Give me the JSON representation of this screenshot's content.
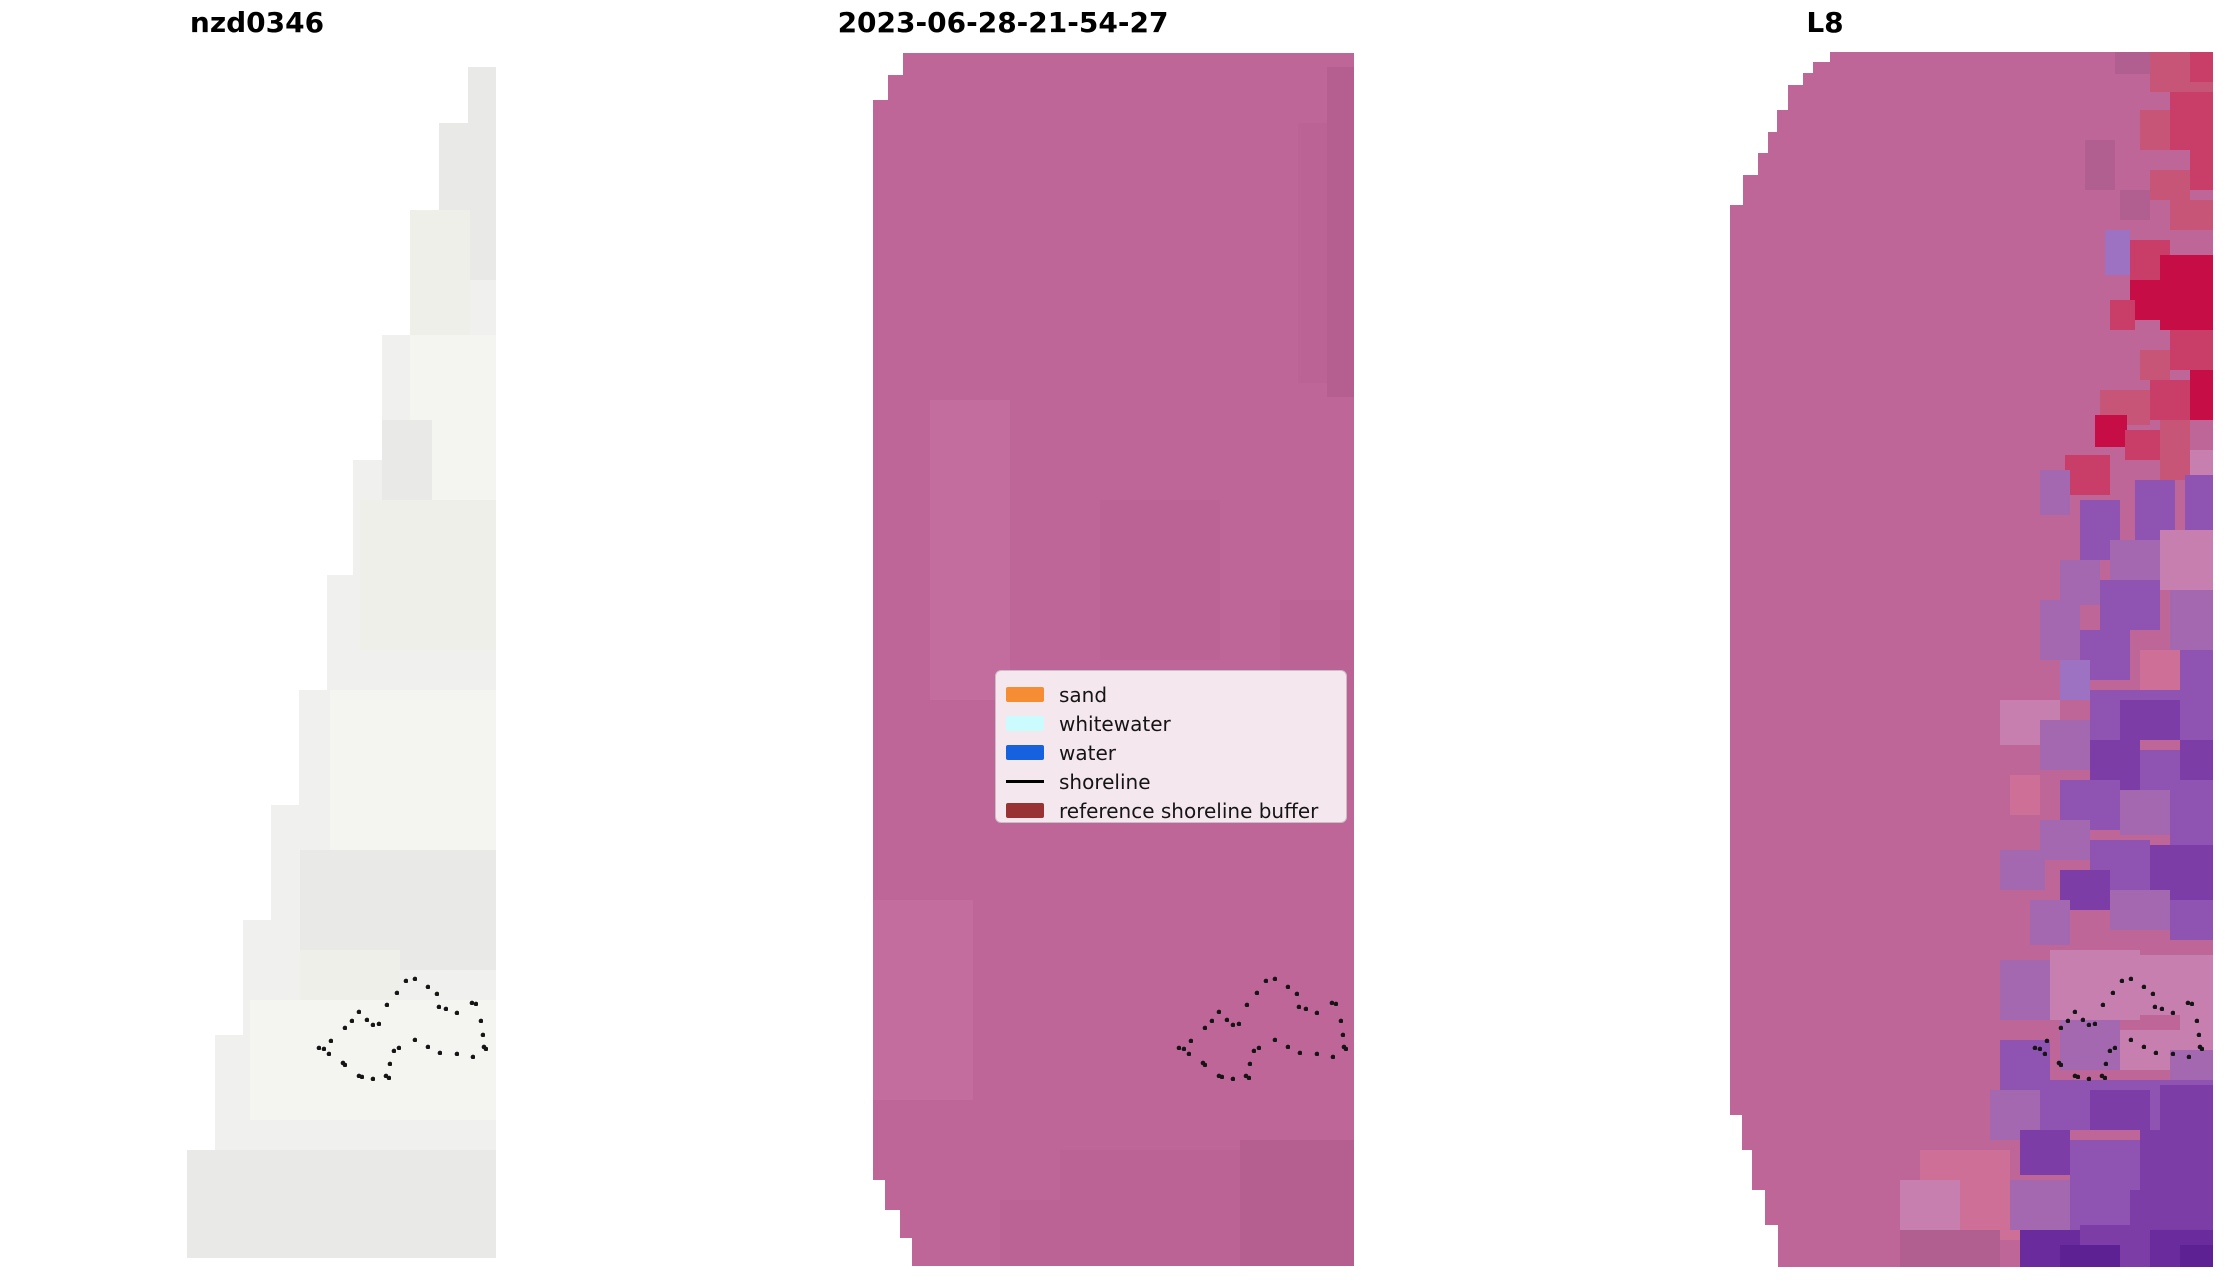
{
  "figure": {
    "width": 2225,
    "height": 1283,
    "background": "#ffffff"
  },
  "chart_data": {
    "type": "heatmap",
    "description": "Three satellite image panels: site id, classified capture date, and L8 sensor image with reference shoreline buffer dots",
    "palette": {
      "g1": "#e9e9e7",
      "g2": "#f4f4f1",
      "g3": "#edefe8",
      "sh1": "#b55f90",
      "sh2": "#c26d9e",
      "sh3": "#ba6394",
      "r1": "#c60d45",
      "r2": "#c93e68",
      "r3": "#c65577",
      "p1": "#7c3da6",
      "p2": "#8f54b2",
      "p3": "#a468b0",
      "p4": "#6a2b9c",
      "p5": "#5d2193",
      "lv": "#9d72c2",
      "pk": "#c77fb0",
      "rs": "#cd6f97",
      "dk": "#b05f90"
    },
    "dot_color": "#151515",
    "dot_radius": 2.3,
    "shoreline_buffer_dots": [
      [
        1275,
        979
      ],
      [
        1266,
        981
      ],
      [
        1288,
        987
      ],
      [
        1297,
        994
      ],
      [
        1257,
        993
      ],
      [
        1247,
        1005
      ],
      [
        1299,
        1007
      ],
      [
        1306,
        1009
      ],
      [
        1332,
        1003
      ],
      [
        1336,
        1004
      ],
      [
        1317,
        1013
      ],
      [
        1341,
        1021
      ],
      [
        1219,
        1012
      ],
      [
        1212,
        1021
      ],
      [
        1205,
        1028
      ],
      [
        1227,
        1020
      ],
      [
        1233,
        1025
      ],
      [
        1239,
        1024
      ],
      [
        1343,
        1035
      ],
      [
        1191,
        1041
      ],
      [
        1184,
        1049
      ],
      [
        1179,
        1048
      ],
      [
        1189,
        1054
      ],
      [
        1275,
        1040
      ],
      [
        1259,
        1048
      ],
      [
        1254,
        1051
      ],
      [
        1288,
        1047
      ],
      [
        1300,
        1053
      ],
      [
        1317,
        1054
      ],
      [
        1333,
        1057
      ],
      [
        1344,
        1047
      ],
      [
        1346,
        1049
      ],
      [
        1203,
        1063
      ],
      [
        1205,
        1065
      ],
      [
        1250,
        1064
      ],
      [
        1219,
        1076
      ],
      [
        1222,
        1077
      ],
      [
        1233,
        1079
      ],
      [
        1246,
        1076
      ],
      [
        1249,
        1078
      ]
    ],
    "panels": [
      {
        "id": "nzd0346",
        "title": "nzd0346",
        "title_cx": 257,
        "base_color": "#f0f0ee",
        "dots_dx": -860,
        "outline": [
          [
            496,
            67
          ],
          [
            468,
            67
          ],
          [
            468,
            123
          ],
          [
            439,
            123
          ],
          [
            439,
            210
          ],
          [
            410,
            210
          ],
          [
            410,
            335
          ],
          [
            382,
            335
          ],
          [
            382,
            460
          ],
          [
            353,
            460
          ],
          [
            353,
            575
          ],
          [
            327,
            575
          ],
          [
            327,
            690
          ],
          [
            299,
            690
          ],
          [
            299,
            805
          ],
          [
            271,
            805
          ],
          [
            271,
            920
          ],
          [
            243,
            920
          ],
          [
            243,
            1035
          ],
          [
            215,
            1035
          ],
          [
            215,
            1150
          ],
          [
            187,
            1150
          ],
          [
            187,
            1258
          ],
          [
            496,
            1258
          ]
        ],
        "texture": [
          [
            439,
            80,
            57,
            200,
            "g1"
          ],
          [
            468,
            67,
            28,
            56,
            "g1"
          ],
          [
            410,
            210,
            60,
            125,
            "g3"
          ],
          [
            410,
            335,
            86,
            180,
            "g2"
          ],
          [
            382,
            420,
            50,
            90,
            "g1"
          ],
          [
            360,
            500,
            136,
            150,
            "g3"
          ],
          [
            330,
            690,
            166,
            160,
            "g2"
          ],
          [
            300,
            850,
            196,
            120,
            "g1"
          ],
          [
            300,
            950,
            100,
            100,
            "g3"
          ],
          [
            250,
            1000,
            246,
            120,
            "g2"
          ],
          [
            187,
            1150,
            309,
            108,
            "g1"
          ]
        ]
      },
      {
        "id": "capture-date",
        "title": "2023-06-28-21-54-27",
        "title_cx": 1003,
        "base_color": "#bd6697",
        "dots_dx": 0,
        "outline": [
          [
            903,
            53
          ],
          [
            1354,
            53
          ],
          [
            1354,
            1266
          ],
          [
            912,
            1266
          ],
          [
            912,
            1238
          ],
          [
            900,
            1238
          ],
          [
            900,
            1210
          ],
          [
            885,
            1210
          ],
          [
            885,
            1180
          ],
          [
            873,
            1180
          ],
          [
            873,
            100
          ],
          [
            888,
            100
          ],
          [
            888,
            75
          ],
          [
            903,
            75
          ]
        ],
        "texture": [
          [
            1327,
            67,
            27,
            330,
            "sh1"
          ],
          [
            1298,
            123,
            29,
            260,
            "sh3"
          ],
          [
            930,
            400,
            80,
            300,
            "sh2"
          ],
          [
            1100,
            500,
            120,
            160,
            "sh3"
          ],
          [
            1280,
            600,
            74,
            200,
            "sh3"
          ],
          [
            873,
            900,
            100,
            200,
            "sh2"
          ],
          [
            1240,
            1140,
            114,
            126,
            "sh1"
          ],
          [
            1060,
            1150,
            180,
            116,
            "sh3"
          ],
          [
            1000,
            1200,
            240,
            66,
            "sh3"
          ]
        ]
      },
      {
        "id": "l8",
        "title": "L8",
        "title_cx": 1825,
        "base_color": "#bd6697",
        "dots_dx": 856,
        "outline": [
          [
            1830,
            52
          ],
          [
            2213,
            52
          ],
          [
            2213,
            1267
          ],
          [
            1778,
            1267
          ],
          [
            1778,
            1225
          ],
          [
            1765,
            1225
          ],
          [
            1765,
            1190
          ],
          [
            1752,
            1190
          ],
          [
            1752,
            1150
          ],
          [
            1742,
            1150
          ],
          [
            1742,
            1115
          ],
          [
            1730,
            1115
          ],
          [
            1730,
            205
          ],
          [
            1743,
            205
          ],
          [
            1743,
            175
          ],
          [
            1758,
            175
          ],
          [
            1758,
            153
          ],
          [
            1768,
            153
          ],
          [
            1768,
            132
          ],
          [
            1777,
            132
          ],
          [
            1777,
            110
          ],
          [
            1788,
            110
          ],
          [
            1788,
            85
          ],
          [
            1803,
            85
          ],
          [
            1803,
            73
          ],
          [
            1813,
            73
          ],
          [
            1813,
            62
          ],
          [
            1830,
            62
          ]
        ],
        "texture": [
          [
            2150,
            52,
            63,
            40,
            "r3"
          ],
          [
            2190,
            52,
            23,
            30,
            "r2"
          ],
          [
            2115,
            52,
            35,
            22,
            "dk"
          ],
          [
            2170,
            92,
            43,
            58,
            "r2"
          ],
          [
            2140,
            110,
            30,
            40,
            "r3"
          ],
          [
            2190,
            150,
            23,
            40,
            "r2"
          ],
          [
            2150,
            170,
            40,
            30,
            "r3"
          ],
          [
            2120,
            190,
            30,
            30,
            "dk"
          ],
          [
            2170,
            200,
            43,
            30,
            "r3"
          ],
          [
            2085,
            140,
            30,
            50,
            "dk"
          ],
          [
            2105,
            230,
            25,
            45,
            "lv"
          ],
          [
            2130,
            240,
            40,
            40,
            "r2"
          ],
          [
            2160,
            255,
            53,
            75,
            "r1"
          ],
          [
            2130,
            280,
            30,
            40,
            "r1"
          ],
          [
            2110,
            300,
            25,
            30,
            "r2"
          ],
          [
            2170,
            330,
            43,
            40,
            "r2"
          ],
          [
            2140,
            350,
            30,
            30,
            "r3"
          ],
          [
            2190,
            370,
            23,
            50,
            "r1"
          ],
          [
            2150,
            380,
            40,
            40,
            "r2"
          ],
          [
            2100,
            390,
            50,
            35,
            "r3"
          ],
          [
            2095,
            415,
            32,
            32,
            "r1"
          ],
          [
            2125,
            430,
            45,
            30,
            "r2"
          ],
          [
            2065,
            455,
            45,
            40,
            "r2"
          ],
          [
            2160,
            420,
            30,
            60,
            "r3"
          ],
          [
            2190,
            450,
            23,
            60,
            "pk"
          ],
          [
            2135,
            480,
            40,
            80,
            "p2"
          ],
          [
            2185,
            475,
            28,
            55,
            "p2"
          ],
          [
            2080,
            500,
            40,
            60,
            "p2"
          ],
          [
            2110,
            540,
            50,
            40,
            "p3"
          ],
          [
            2060,
            560,
            40,
            45,
            "p3"
          ],
          [
            2160,
            530,
            53,
            60,
            "pk"
          ],
          [
            2100,
            580,
            60,
            50,
            "p2"
          ],
          [
            2170,
            590,
            43,
            60,
            "p3"
          ],
          [
            2040,
            600,
            40,
            60,
            "p3"
          ],
          [
            2080,
            630,
            50,
            50,
            "p2"
          ],
          [
            2140,
            650,
            40,
            40,
            "rs"
          ],
          [
            2180,
            650,
            33,
            50,
            "p2"
          ],
          [
            2060,
            660,
            30,
            40,
            "lv"
          ],
          [
            2040,
            470,
            30,
            45,
            "p3"
          ],
          [
            2090,
            690,
            123,
            50,
            "p2"
          ],
          [
            2120,
            700,
            60,
            40,
            "p1"
          ],
          [
            2000,
            700,
            60,
            45,
            "pk"
          ],
          [
            2040,
            720,
            50,
            50,
            "p3"
          ],
          [
            2090,
            740,
            50,
            50,
            "p1"
          ],
          [
            2140,
            750,
            73,
            50,
            "p2"
          ],
          [
            2180,
            740,
            33,
            40,
            "p1"
          ],
          [
            2010,
            775,
            30,
            40,
            "rs"
          ],
          [
            2060,
            780,
            60,
            50,
            "p2"
          ],
          [
            2120,
            790,
            50,
            45,
            "p3"
          ],
          [
            2170,
            800,
            43,
            50,
            "p2"
          ],
          [
            2040,
            820,
            50,
            40,
            "p3"
          ],
          [
            2090,
            840,
            60,
            50,
            "p2"
          ],
          [
            2150,
            845,
            63,
            55,
            "p1"
          ],
          [
            2000,
            850,
            45,
            40,
            "p3"
          ],
          [
            2060,
            870,
            50,
            40,
            "p1"
          ],
          [
            2110,
            890,
            60,
            40,
            "p3"
          ],
          [
            2170,
            900,
            43,
            40,
            "p2"
          ],
          [
            2030,
            900,
            40,
            45,
            "p3"
          ],
          [
            2050,
            950,
            90,
            70,
            "pk"
          ],
          [
            2140,
            955,
            73,
            60,
            "pk"
          ],
          [
            2000,
            960,
            50,
            60,
            "p3"
          ],
          [
            2180,
            1010,
            33,
            40,
            "pk"
          ],
          [
            2060,
            1020,
            60,
            50,
            "p3"
          ],
          [
            2120,
            1030,
            60,
            40,
            "pk"
          ],
          [
            2000,
            1040,
            50,
            50,
            "p2"
          ],
          [
            2170,
            1050,
            43,
            40,
            "p3"
          ],
          [
            2040,
            1080,
            173,
            50,
            "p2"
          ],
          [
            2090,
            1090,
            60,
            40,
            "p1"
          ],
          [
            2160,
            1085,
            53,
            45,
            "p1"
          ],
          [
            1990,
            1090,
            50,
            50,
            "p3"
          ],
          [
            2020,
            1130,
            50,
            45,
            "p1"
          ],
          [
            2070,
            1140,
            70,
            50,
            "p2"
          ],
          [
            2140,
            1130,
            73,
            60,
            "p1"
          ],
          [
            1920,
            1150,
            90,
            60,
            "rs"
          ],
          [
            1900,
            1180,
            60,
            50,
            "pk"
          ],
          [
            1960,
            1190,
            60,
            50,
            "rs"
          ],
          [
            2010,
            1180,
            60,
            50,
            "p3"
          ],
          [
            2070,
            1190,
            60,
            50,
            "p2"
          ],
          [
            2130,
            1190,
            83,
            40,
            "p1"
          ],
          [
            2020,
            1230,
            60,
            37,
            "p4"
          ],
          [
            2080,
            1225,
            70,
            42,
            "p1"
          ],
          [
            2150,
            1230,
            63,
            37,
            "p4"
          ],
          [
            2060,
            1245,
            60,
            22,
            "p5"
          ],
          [
            2180,
            1245,
            33,
            22,
            "p5"
          ],
          [
            1900,
            1230,
            100,
            37,
            "dk"
          ]
        ]
      }
    ],
    "legend": {
      "x": 995,
      "y": 670,
      "width": 352,
      "height": 153,
      "bg": "#f5e7ee",
      "border": "#c9bdc6",
      "entries": [
        {
          "label": "sand",
          "color": "#f68d35",
          "type": "patch"
        },
        {
          "label": "whitewater",
          "color": "#ccfbfd",
          "type": "patch"
        },
        {
          "label": "water",
          "color": "#1661de",
          "type": "patch"
        },
        {
          "label": "shoreline",
          "color": "#000000",
          "type": "line"
        },
        {
          "label": "reference shoreline buffer",
          "color": "#993333",
          "type": "patch"
        }
      ]
    }
  }
}
